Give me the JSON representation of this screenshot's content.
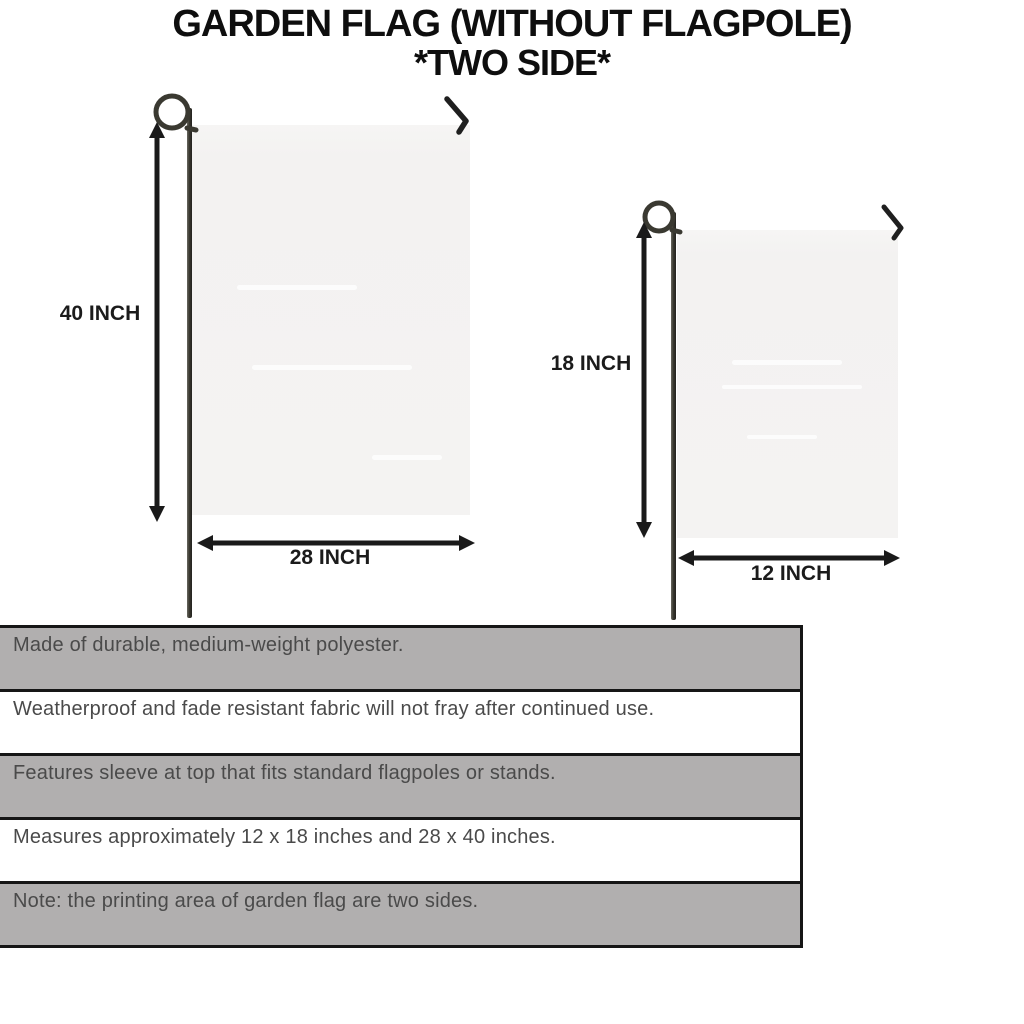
{
  "title": {
    "line1": "GARDEN FLAG (WITHOUT FLAGPOLE)",
    "line2": "*TWO SIDE*"
  },
  "diagrams": {
    "large_flag": {
      "height_label": "40 INCH",
      "width_label": "28 INCH"
    },
    "small_flag": {
      "height_label": "18 INCH",
      "width_label": "12 INCH"
    }
  },
  "features": [
    {
      "text": "Made of durable, medium-weight polyester."
    },
    {
      "text": "Weatherproof and fade resistant fabric will not fray after continued use."
    },
    {
      "text": "Features sleeve at top that fits standard flagpoles or stands."
    },
    {
      "text": "Measures approximately 12 x 18 inches and 28 x 40 inches."
    },
    {
      "text": "Note: the printing area of garden flag are two sides."
    }
  ],
  "colors": {
    "background": "#ffffff",
    "title_text": "#0e0e0e",
    "dimension_text": "#1b1b1b",
    "arrow": "#1a1a1a",
    "pole": "#3a3931",
    "flag_fill": "#f4f3f2",
    "table_shaded_row": "#b1afaf",
    "table_white_row": "#ffffff",
    "table_border": "#161616",
    "table_text": "#4a4a4a"
  }
}
